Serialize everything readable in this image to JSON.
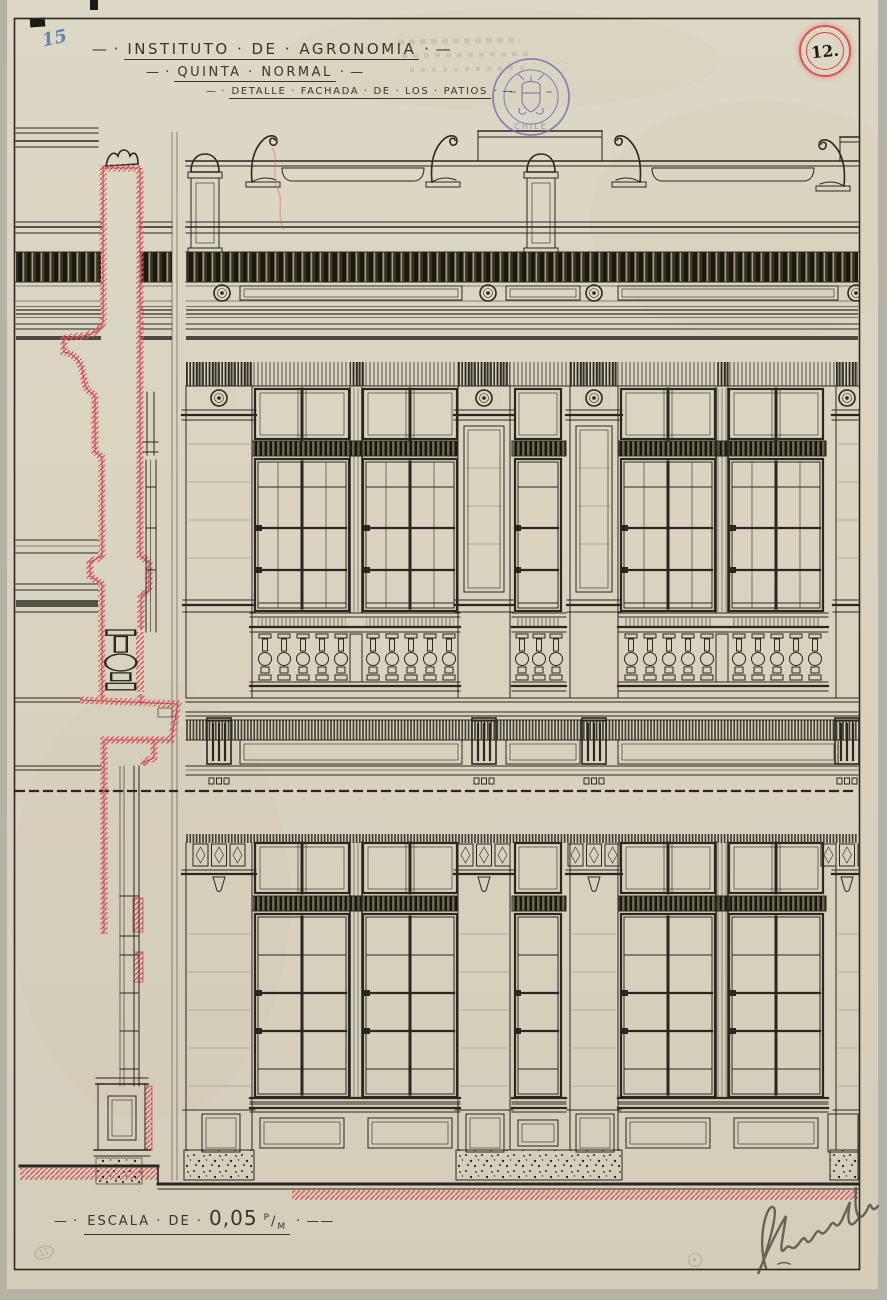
{
  "page": {
    "pencil_index": "15",
    "sheet_circle_number": "12.",
    "title": {
      "lead": "— ·",
      "text": "INSTITUTO · DE · AGRONOMIA",
      "trail": "· —"
    },
    "subtitle": {
      "lead": "— ·",
      "text": "QUINTA · NORMAL",
      "trail": "· —"
    },
    "detail": {
      "lead": "— ·",
      "text": "DETALLE · FACHADA · DE · LOS · PATIOS",
      "trail": "· —"
    },
    "scale": {
      "lead": "— ·",
      "label": "ESCALA · DE ·",
      "value": "0,05",
      "unit_sup": "P",
      "unit_slash": "/",
      "unit_sub": "M",
      "trail": "· ——"
    },
    "stamp": {
      "bottom_text": "· CHILE ·"
    },
    "pencil_corner_mark": "11"
  },
  "colors": {
    "paper": "#d8d2bf",
    "ink": "#2b2720",
    "section_red": "#d9565c",
    "stamp_blue": "#6b6cb5",
    "pencil_blue": "#4779b8",
    "circle_red": "#e05252"
  }
}
